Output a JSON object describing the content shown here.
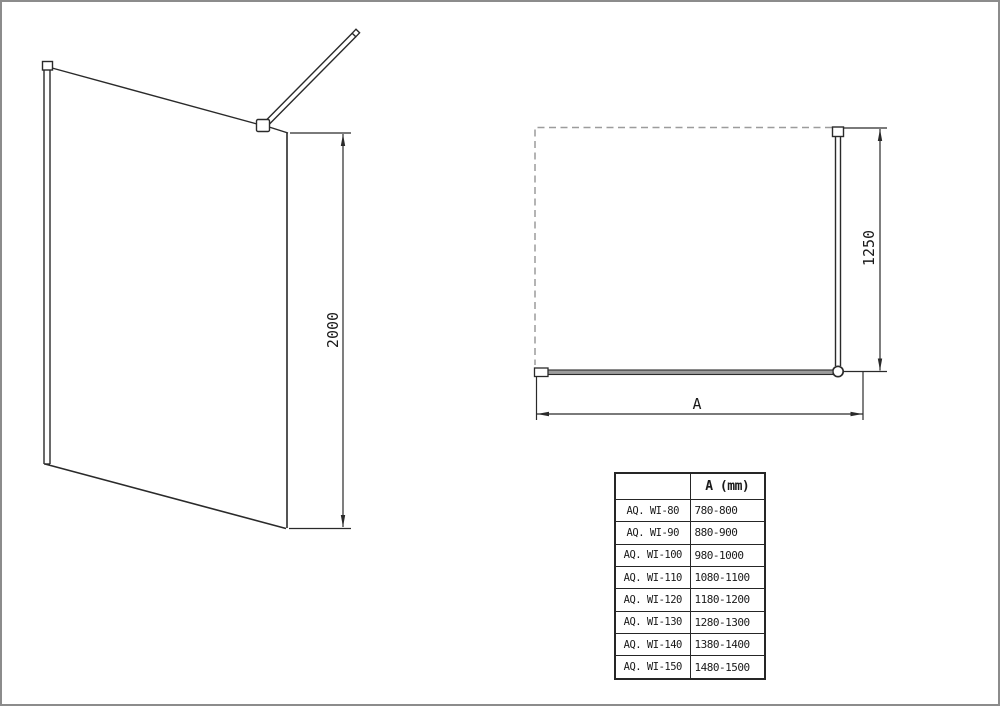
{
  "drawing": {
    "view_3d": {
      "height_dim_label": "2000"
    },
    "plan_view": {
      "bar_dim_label": "1250",
      "width_dim_label": "A"
    },
    "colors": {
      "line": "#2a2a2a",
      "dashed_line": "#9c9c9c",
      "glass_fill": "#9c9c9c",
      "page_border": "#8c8c8c"
    }
  },
  "table": {
    "header": {
      "model": "",
      "a_mm": "A (mm)"
    },
    "rows": [
      {
        "model": "AQ. WI-80",
        "range": "780-800"
      },
      {
        "model": "AQ. WI-90",
        "range": "880-900"
      },
      {
        "model": "AQ. WI-100",
        "range": "980-1000"
      },
      {
        "model": "AQ. WI-110",
        "range": "1080-1100"
      },
      {
        "model": "AQ. WI-120",
        "range": "1180-1200"
      },
      {
        "model": "AQ. WI-130",
        "range": "1280-1300"
      },
      {
        "model": "AQ. WI-140",
        "range": "1380-1400"
      },
      {
        "model": "AQ. WI-150",
        "range": "1480-1500"
      }
    ]
  }
}
